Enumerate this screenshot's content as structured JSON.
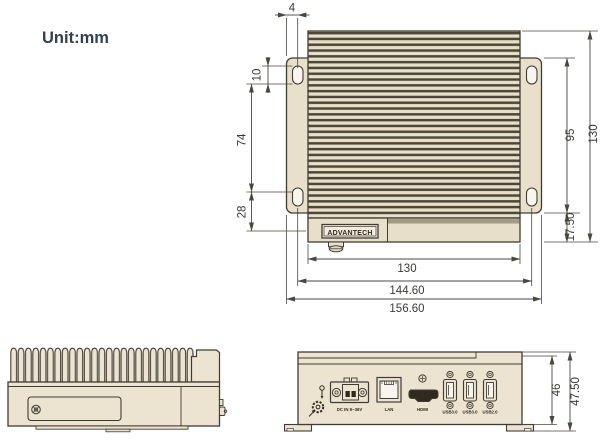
{
  "drawing": {
    "unit_label": "Unit:mm",
    "brand": "ADVANTECH"
  },
  "colors": {
    "body_fill": "#ece4d1",
    "bracket_fill": "#e9e0cc",
    "fin_dark": "#4d4737",
    "outline": "#403c34",
    "dim_line": "#4a473f",
    "title_text": "#35404f"
  },
  "top_view": {
    "dims": {
      "slot_offset": "4",
      "slot_length": "10",
      "slot_spacing": "74",
      "slot_to_front": "28",
      "bracket_height": "95",
      "depth": "130",
      "front_offset": "17.50",
      "body_width": "130",
      "mount_width": "144.60",
      "overall_width": "156.60"
    }
  },
  "front_view": {
    "ports": {
      "power_label": "DC IN 9~36V",
      "lan_label": "LAN",
      "hdmi_label": "HDMI",
      "usb1_label": "USB3.0",
      "usb2_label": "USB3.0",
      "usb3_label": "USB2.0"
    },
    "dims": {
      "body_height": "46",
      "overall_height": "47.50"
    }
  }
}
